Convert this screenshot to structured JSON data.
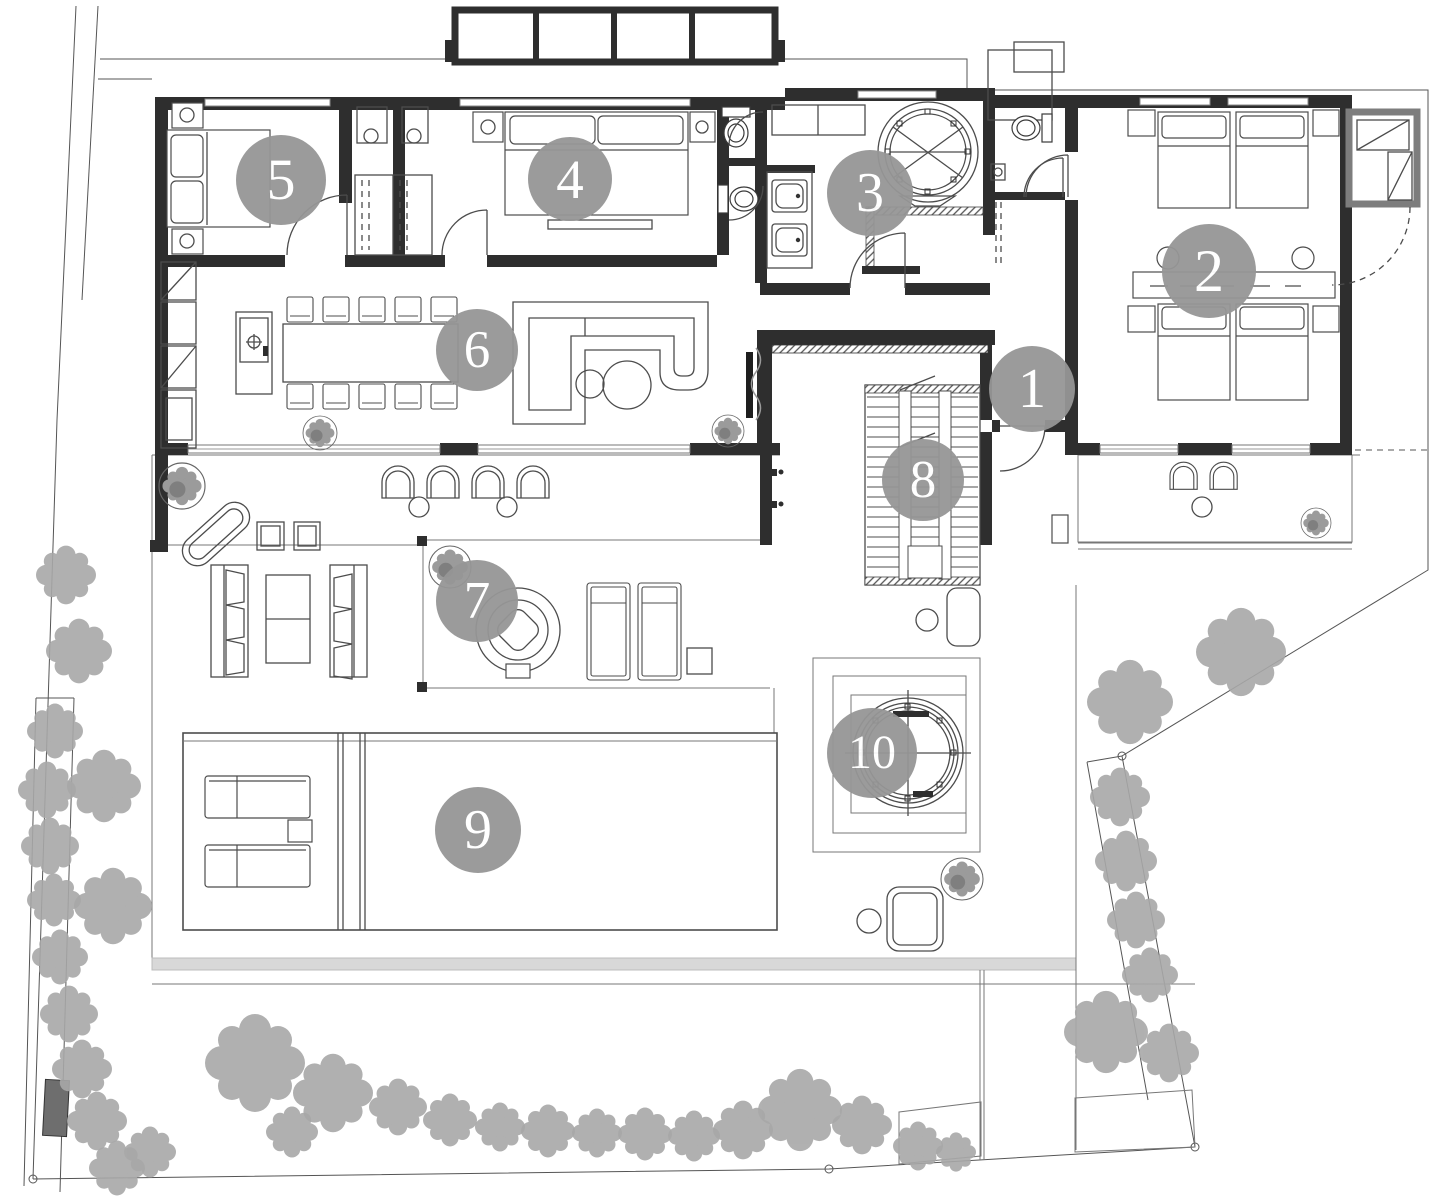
{
  "markers": [
    {
      "number": "1"
    },
    {
      "number": "2"
    },
    {
      "number": "3"
    },
    {
      "number": "4"
    },
    {
      "number": "5"
    },
    {
      "number": "6"
    },
    {
      "number": "7"
    },
    {
      "number": "8"
    },
    {
      "number": "9"
    },
    {
      "number": "10"
    }
  ],
  "palette": {
    "marker_fill": "#969696",
    "marker_text": "#ffffff",
    "wall": "#2e2e2e",
    "furniture_line": "#4c4c4c",
    "boundary_line": "#555555",
    "tree": "#a8a8a8",
    "utility_wall": "#7d7d7d",
    "terrace_band": "#d8d8d8",
    "gate": "#6e6e6e",
    "background": "#ffffff"
  }
}
